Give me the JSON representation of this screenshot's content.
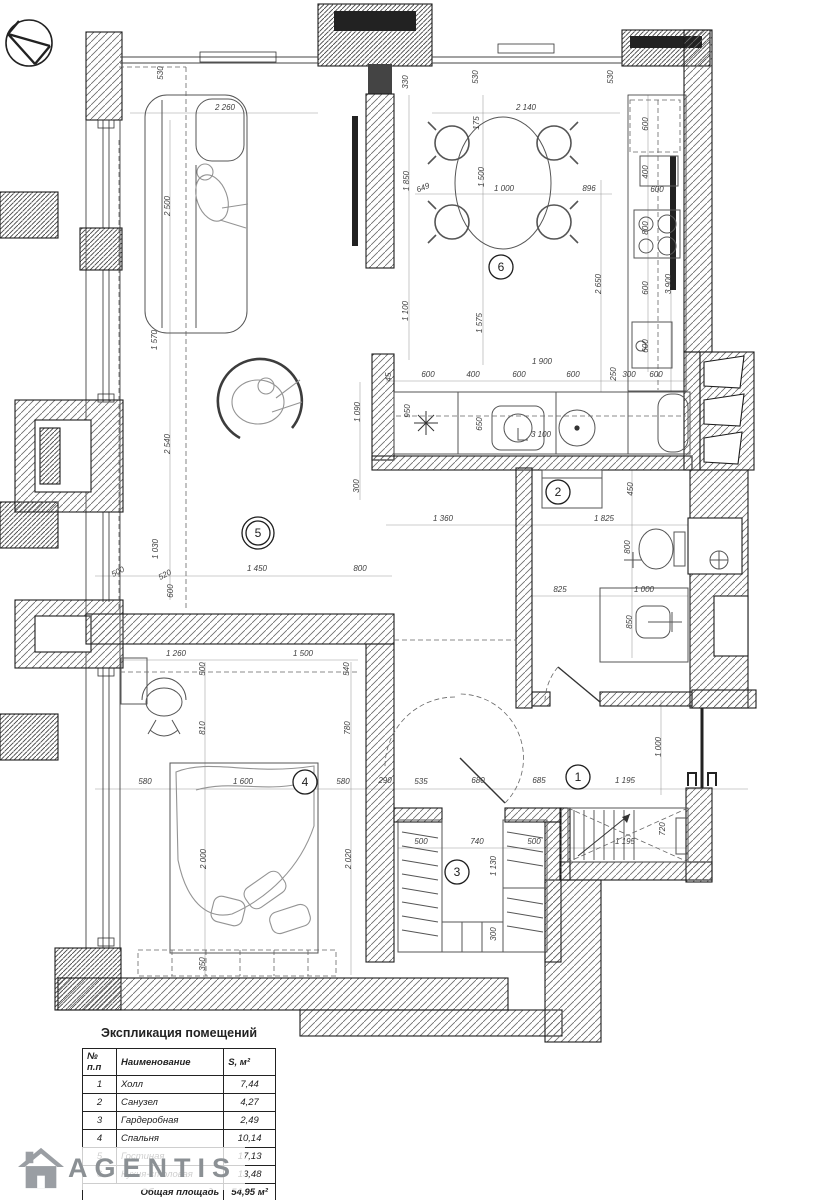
{
  "branding": {
    "name": "AGENTIS"
  },
  "schedule": {
    "title": "Экспликация помещений",
    "columns": [
      "№ п.п",
      "Наименование",
      "S, м²"
    ],
    "rows": [
      [
        "1",
        "Холл",
        "7,44"
      ],
      [
        "2",
        "Санузел",
        "4,27"
      ],
      [
        "3",
        "Гардеробная",
        "2,49"
      ],
      [
        "4",
        "Спальня",
        "10,14"
      ],
      [
        "5",
        "Гостиная",
        "17,13"
      ],
      [
        "6",
        "Кухня-столовая",
        "13,48"
      ]
    ],
    "total_label": "Общая площадь",
    "total_value": "54,95 м²"
  },
  "plan": {
    "room_markers": [
      {
        "n": "1",
        "x": 578,
        "y": 777
      },
      {
        "n": "2",
        "x": 558,
        "y": 492
      },
      {
        "n": "3",
        "x": 457,
        "y": 872
      },
      {
        "n": "4",
        "x": 305,
        "y": 782
      },
      {
        "n": "5",
        "x": 258,
        "y": 533,
        "double": true
      },
      {
        "n": "6",
        "x": 501,
        "y": 267
      }
    ],
    "dimensions": [
      {
        "t": "530",
        "x": 163,
        "y": 73,
        "r": -90
      },
      {
        "t": "2 260",
        "x": 225,
        "y": 110
      },
      {
        "t": "2 500",
        "x": 170,
        "y": 206,
        "r": -90
      },
      {
        "t": "1 570",
        "x": 157,
        "y": 340,
        "r": -90
      },
      {
        "t": "2 540",
        "x": 170,
        "y": 444,
        "r": -90
      },
      {
        "t": "1 030",
        "x": 158,
        "y": 549,
        "r": -90
      },
      {
        "t": "500",
        "x": 119,
        "y": 574,
        "r": -28
      },
      {
        "t": "520",
        "x": 166,
        "y": 577,
        "r": -28
      },
      {
        "t": "600",
        "x": 173,
        "y": 591,
        "r": -90
      },
      {
        "t": "1 450",
        "x": 257,
        "y": 571
      },
      {
        "t": "800",
        "x": 360,
        "y": 571
      },
      {
        "t": "330",
        "x": 408,
        "y": 82,
        "r": -90
      },
      {
        "t": "530",
        "x": 478,
        "y": 77,
        "r": -90
      },
      {
        "t": "2 140",
        "x": 526,
        "y": 110
      },
      {
        "t": "175",
        "x": 479,
        "y": 123,
        "r": -90
      },
      {
        "t": "530",
        "x": 613,
        "y": 77,
        "r": -90
      },
      {
        "t": "1 850",
        "x": 409,
        "y": 181,
        "r": -90
      },
      {
        "t": "1 500",
        "x": 484,
        "y": 177,
        "r": -90
      },
      {
        "t": "649",
        "x": 424,
        "y": 190,
        "r": -22
      },
      {
        "t": "1 000",
        "x": 504,
        "y": 191
      },
      {
        "t": "896",
        "x": 589,
        "y": 191
      },
      {
        "t": "600",
        "x": 648,
        "y": 124,
        "r": -90
      },
      {
        "t": "400",
        "x": 648,
        "y": 172,
        "r": -90
      },
      {
        "t": "600",
        "x": 657,
        "y": 192
      },
      {
        "t": "800",
        "x": 648,
        "y": 228,
        "r": -90
      },
      {
        "t": "600",
        "x": 648,
        "y": 288,
        "r": -90
      },
      {
        "t": "2 650",
        "x": 601,
        "y": 284,
        "r": -90
      },
      {
        "t": "3 900",
        "x": 671,
        "y": 284,
        "r": -90
      },
      {
        "t": "600",
        "x": 648,
        "y": 346,
        "r": -90
      },
      {
        "t": "250",
        "x": 616,
        "y": 374,
        "r": -90
      },
      {
        "t": "1 100",
        "x": 408,
        "y": 311,
        "r": -90
      },
      {
        "t": "1 575",
        "x": 482,
        "y": 323,
        "r": -90
      },
      {
        "t": "1 900",
        "x": 542,
        "y": 364
      },
      {
        "t": "45",
        "x": 391,
        "y": 377,
        "r": -90
      },
      {
        "t": "600",
        "x": 428,
        "y": 377
      },
      {
        "t": "400",
        "x": 473,
        "y": 377
      },
      {
        "t": "600",
        "x": 519,
        "y": 377
      },
      {
        "t": "600",
        "x": 573,
        "y": 377
      },
      {
        "t": "300",
        "x": 629,
        "y": 377
      },
      {
        "t": "600",
        "x": 656,
        "y": 377
      },
      {
        "t": "950",
        "x": 410,
        "y": 411,
        "r": -90
      },
      {
        "t": "1 090",
        "x": 360,
        "y": 412,
        "r": -90
      },
      {
        "t": "650",
        "x": 482,
        "y": 424,
        "r": -90
      },
      {
        "t": "3 100",
        "x": 541,
        "y": 437
      },
      {
        "t": "300",
        "x": 359,
        "y": 486,
        "r": -90
      },
      {
        "t": "1 360",
        "x": 443,
        "y": 521
      },
      {
        "t": "1 825",
        "x": 604,
        "y": 521
      },
      {
        "t": "450",
        "x": 633,
        "y": 489,
        "r": -90
      },
      {
        "t": "800",
        "x": 630,
        "y": 547,
        "r": -90
      },
      {
        "t": "825",
        "x": 560,
        "y": 592
      },
      {
        "t": "1 000",
        "x": 644,
        "y": 592
      },
      {
        "t": "850",
        "x": 632,
        "y": 622,
        "r": -90
      },
      {
        "t": "1 260",
        "x": 176,
        "y": 656
      },
      {
        "t": "1 500",
        "x": 303,
        "y": 656
      },
      {
        "t": "500",
        "x": 205,
        "y": 669,
        "r": -90
      },
      {
        "t": "540",
        "x": 349,
        "y": 669,
        "r": -90
      },
      {
        "t": "810",
        "x": 205,
        "y": 728,
        "r": -90
      },
      {
        "t": "780",
        "x": 350,
        "y": 728,
        "r": -90
      },
      {
        "t": "580",
        "x": 145,
        "y": 784
      },
      {
        "t": "1 600",
        "x": 243,
        "y": 784
      },
      {
        "t": "580",
        "x": 343,
        "y": 784
      },
      {
        "t": "290",
        "x": 385,
        "y": 783
      },
      {
        "t": "535",
        "x": 421,
        "y": 784
      },
      {
        "t": "680",
        "x": 478,
        "y": 783
      },
      {
        "t": "685",
        "x": 539,
        "y": 783
      },
      {
        "t": "1 195",
        "x": 625,
        "y": 783
      },
      {
        "t": "1 000",
        "x": 661,
        "y": 747,
        "r": -90
      },
      {
        "t": "2 000",
        "x": 206,
        "y": 859,
        "r": -90
      },
      {
        "t": "2 020",
        "x": 351,
        "y": 859,
        "r": -90
      },
      {
        "t": "350",
        "x": 205,
        "y": 964,
        "r": -90
      },
      {
        "t": "500",
        "x": 421,
        "y": 844
      },
      {
        "t": "740",
        "x": 477,
        "y": 844
      },
      {
        "t": "500",
        "x": 534,
        "y": 844
      },
      {
        "t": "1 130",
        "x": 496,
        "y": 866,
        "r": -90
      },
      {
        "t": "300",
        "x": 496,
        "y": 934,
        "r": -90
      },
      {
        "t": "720",
        "x": 665,
        "y": 829,
        "r": -90
      },
      {
        "t": "1 195",
        "x": 625,
        "y": 844
      }
    ]
  }
}
